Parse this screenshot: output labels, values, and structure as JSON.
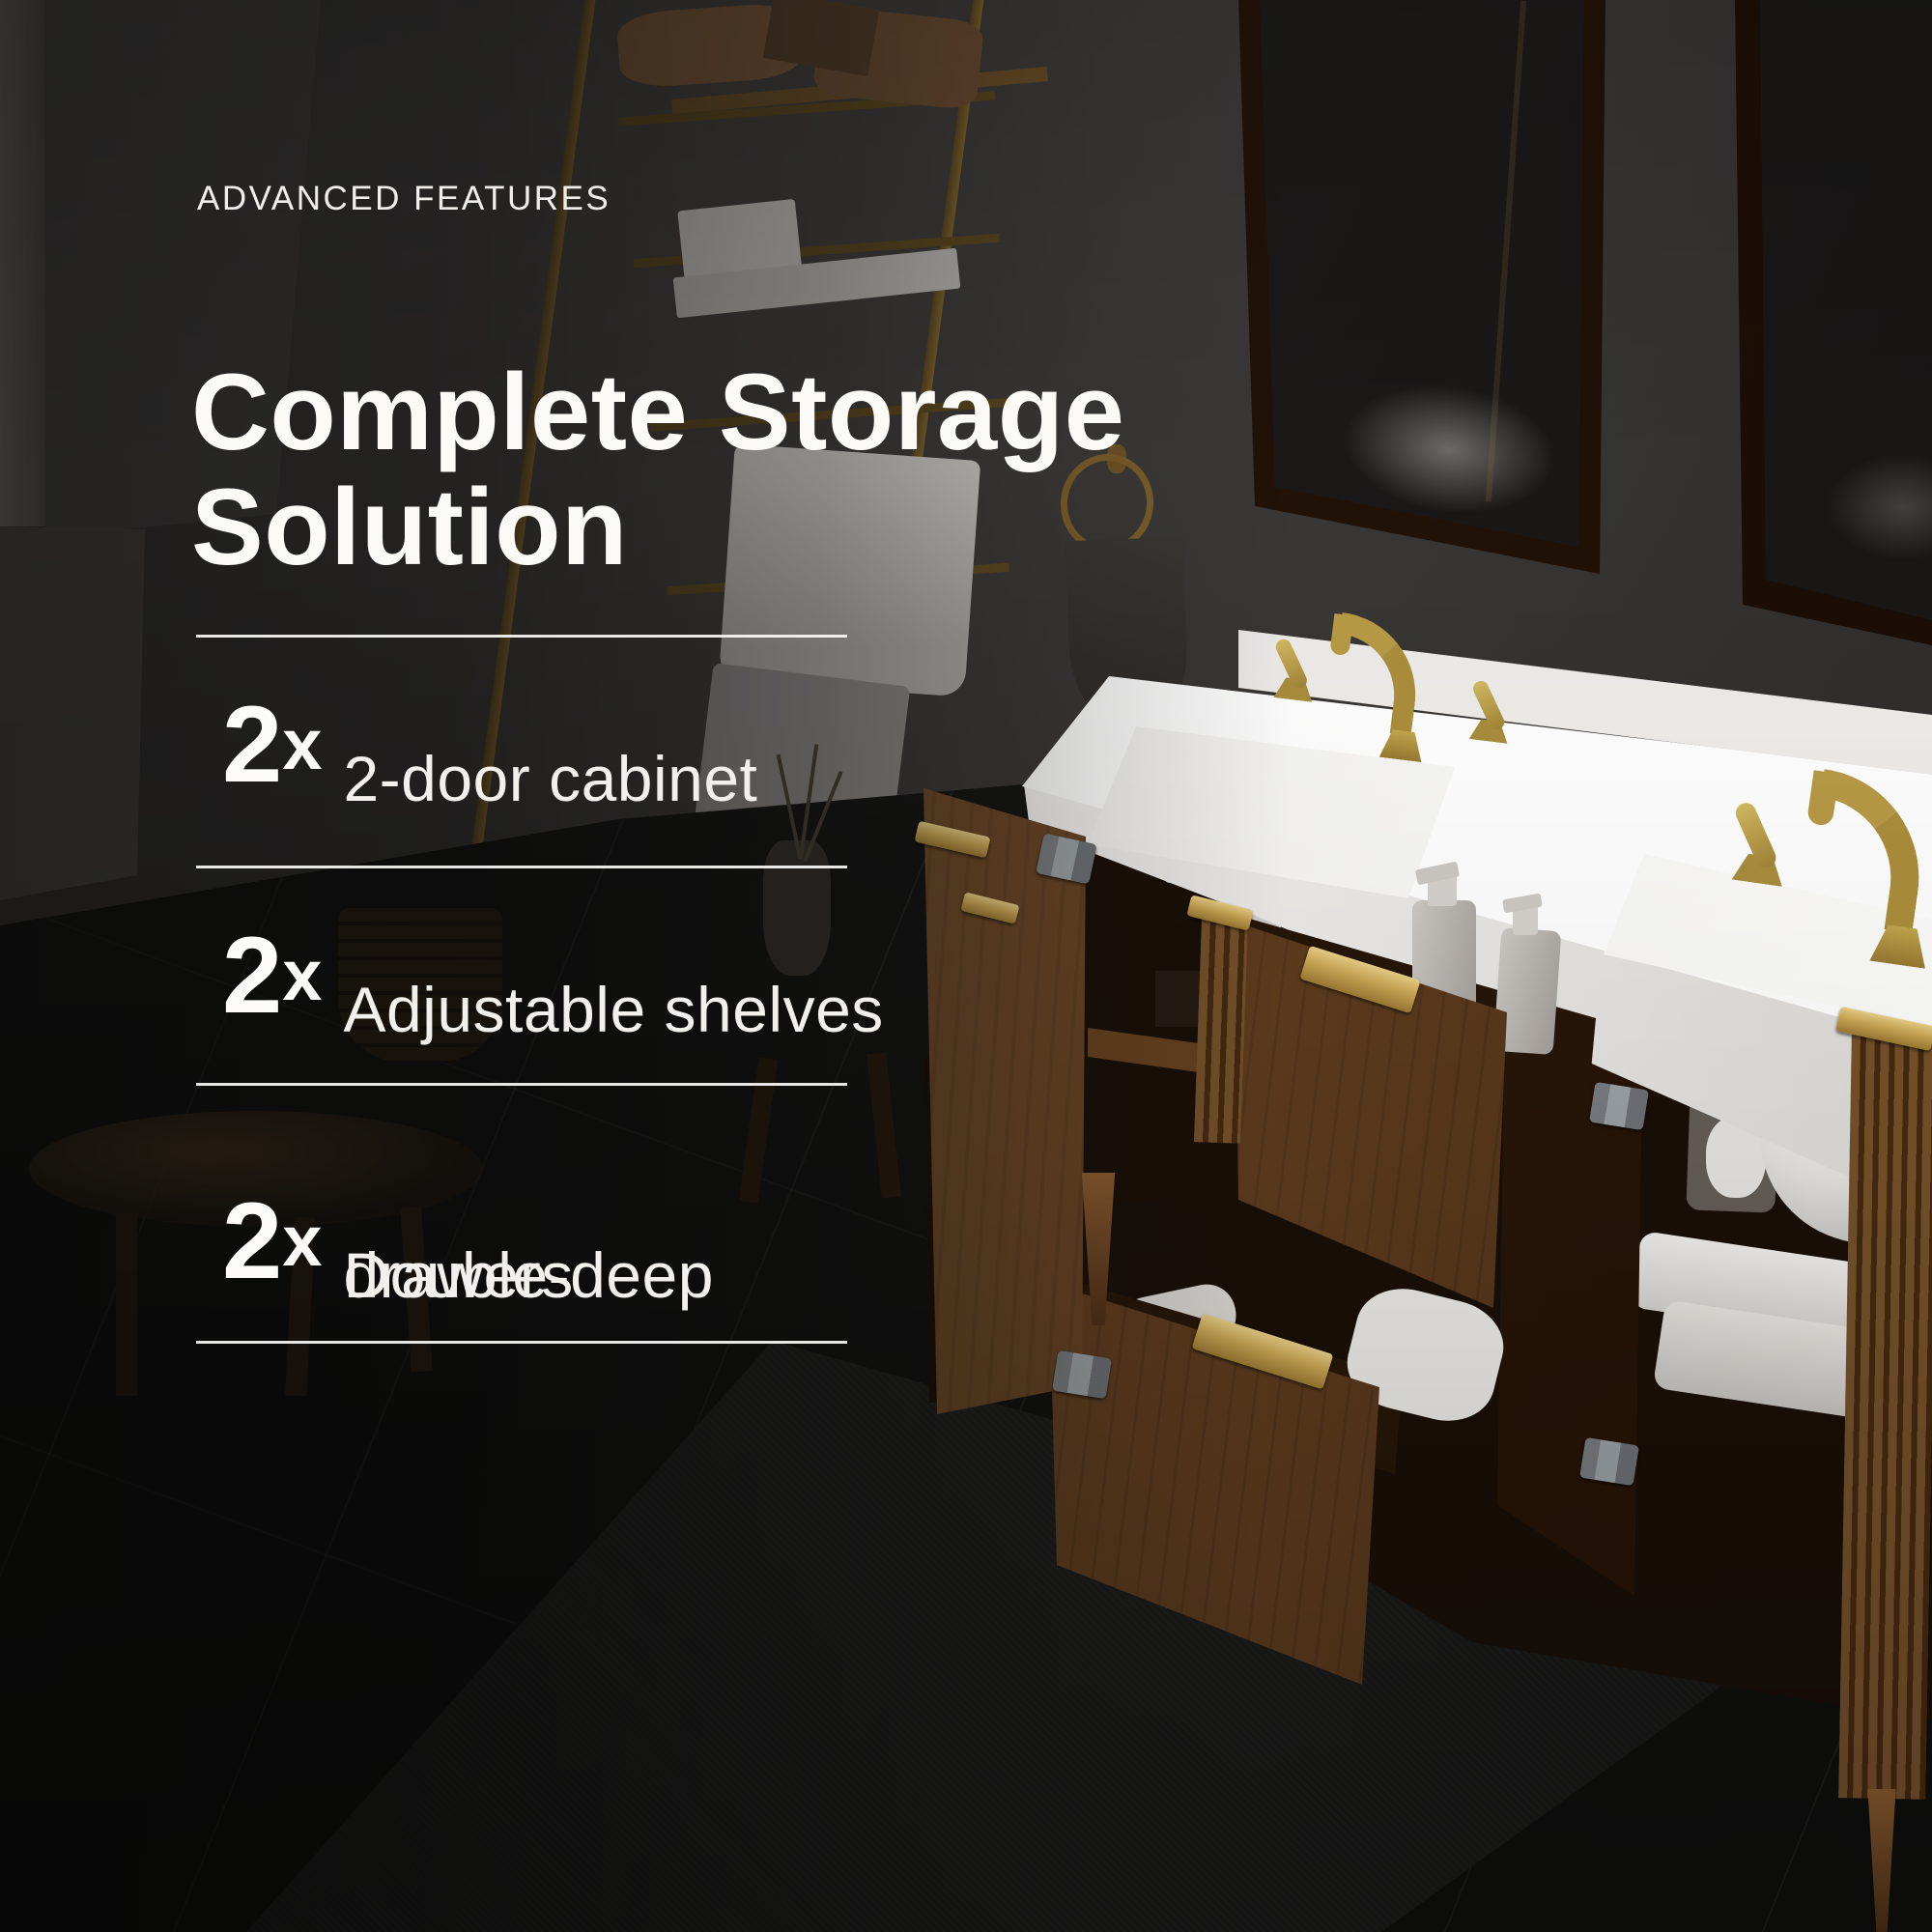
{
  "eyebrow": "ADVANCED FEATURES",
  "headline": {
    "line1": "Complete Storage",
    "line2": "Solution"
  },
  "features": [
    {
      "qty": "2",
      "times": "x",
      "line1": "2-door cabinet",
      "line2": ""
    },
    {
      "qty": "2",
      "times": "x",
      "line1": "Adjustable shelves",
      "line2": ""
    },
    {
      "qty": "2",
      "times": "x",
      "line1": "Double-deep",
      "line2": "drawers"
    }
  ],
  "colors": {
    "text": "#fbfaf7",
    "divider": "#faf9f7",
    "accent_gold": "#caa755",
    "counter_white": "#fdfdfc",
    "wood_walnut": "#6b4526",
    "wall_charcoal": "#3a3837",
    "floor_black": "#141413"
  }
}
